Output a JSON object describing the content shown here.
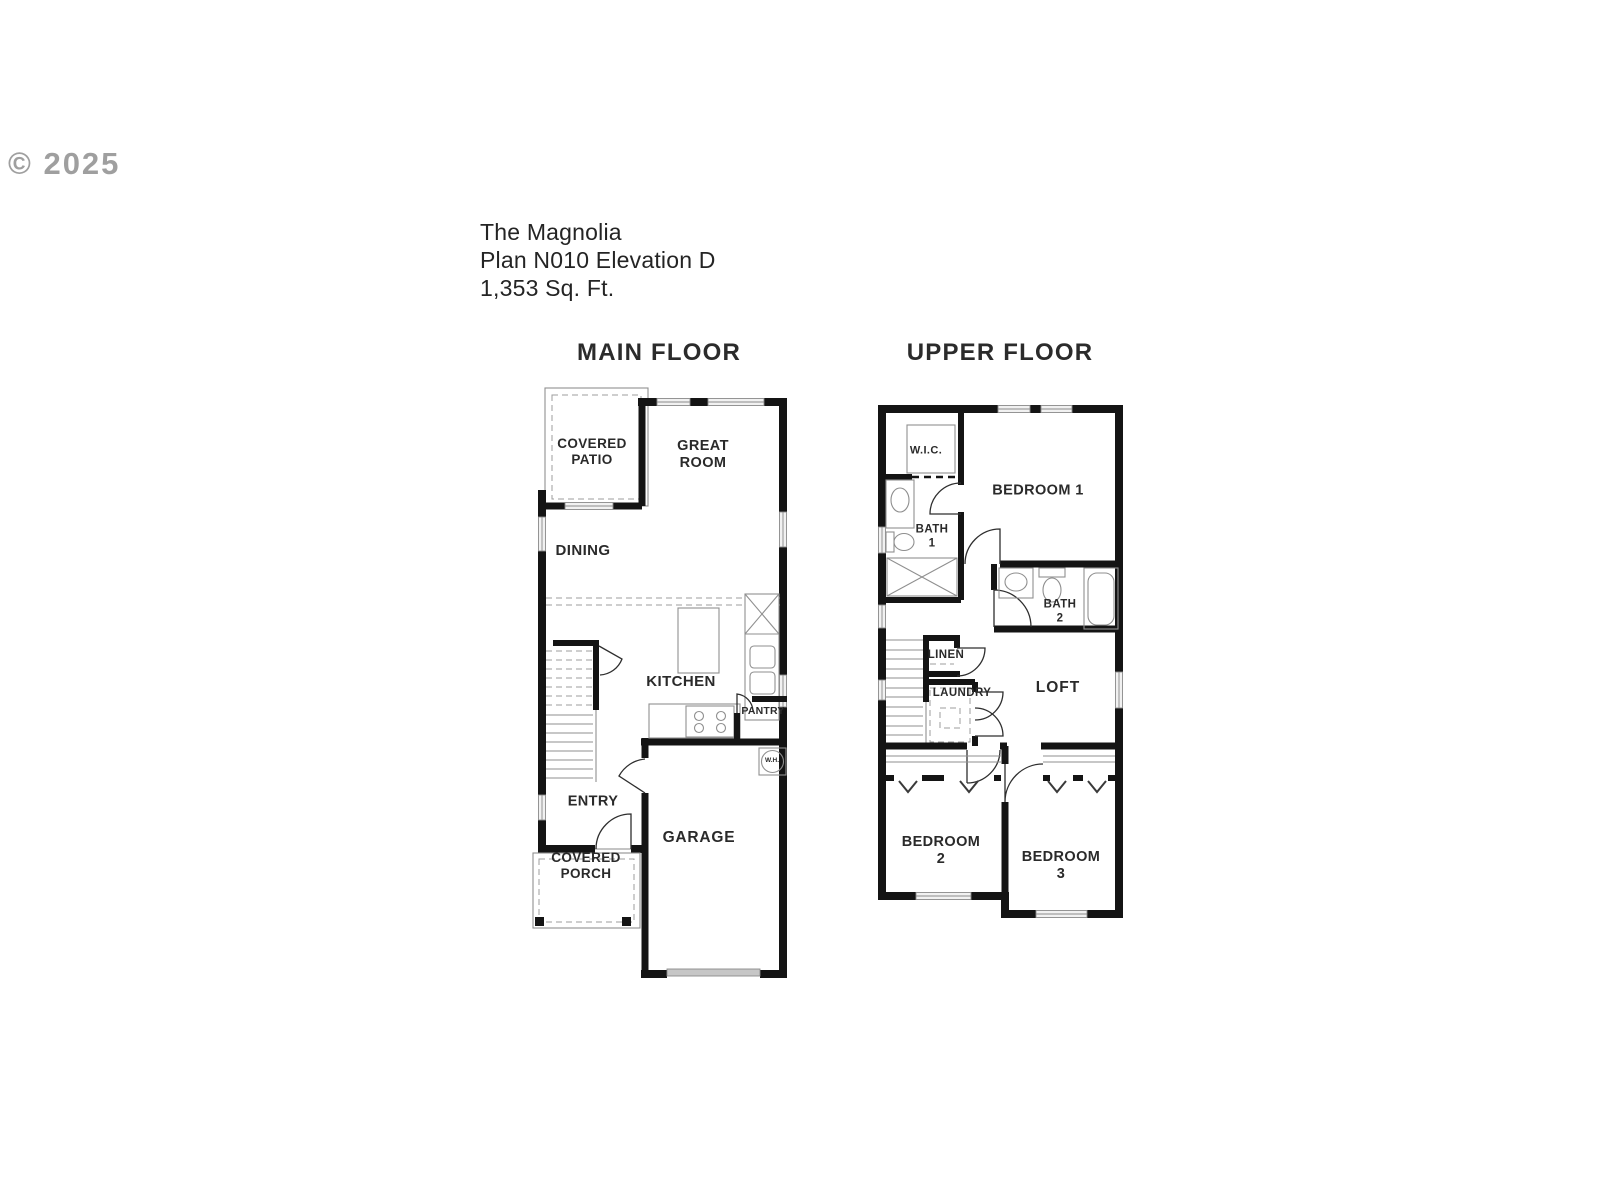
{
  "watermark": "© 2025",
  "title": {
    "line1": "The Magnolia",
    "line2": "Plan N010 Elevation D",
    "line3": "1,353 Sq. Ft."
  },
  "plans": {
    "main": {
      "heading": "MAIN FLOOR",
      "rooms": {
        "covered_patio": "COVERED\nPATIO",
        "great_room": "GREAT\nROOM",
        "dining": "DINING",
        "kitchen": "KITCHEN",
        "pantry": "PANTRY",
        "water_heater": "W.H.",
        "entry": "ENTRY",
        "covered_porch": "COVERED\nPORCH",
        "garage": "GARAGE"
      }
    },
    "upper": {
      "heading": "UPPER FLOOR",
      "rooms": {
        "wic": "W.I.C.",
        "bedroom1": "BEDROOM 1",
        "bath1": "BATH\n1",
        "bath2": "BATH\n2",
        "linen": "LINEN",
        "laundry": "LAUNDRY",
        "loft": "LOFT",
        "bedroom2": "BEDROOM\n2",
        "bedroom3": "BEDROOM\n3"
      }
    }
  },
  "colors": {
    "wall": "#141414",
    "thin_line": "#8f8f8f",
    "text": "#2a2a2a",
    "watermark": "#8f8f8f",
    "background": "#ffffff"
  }
}
